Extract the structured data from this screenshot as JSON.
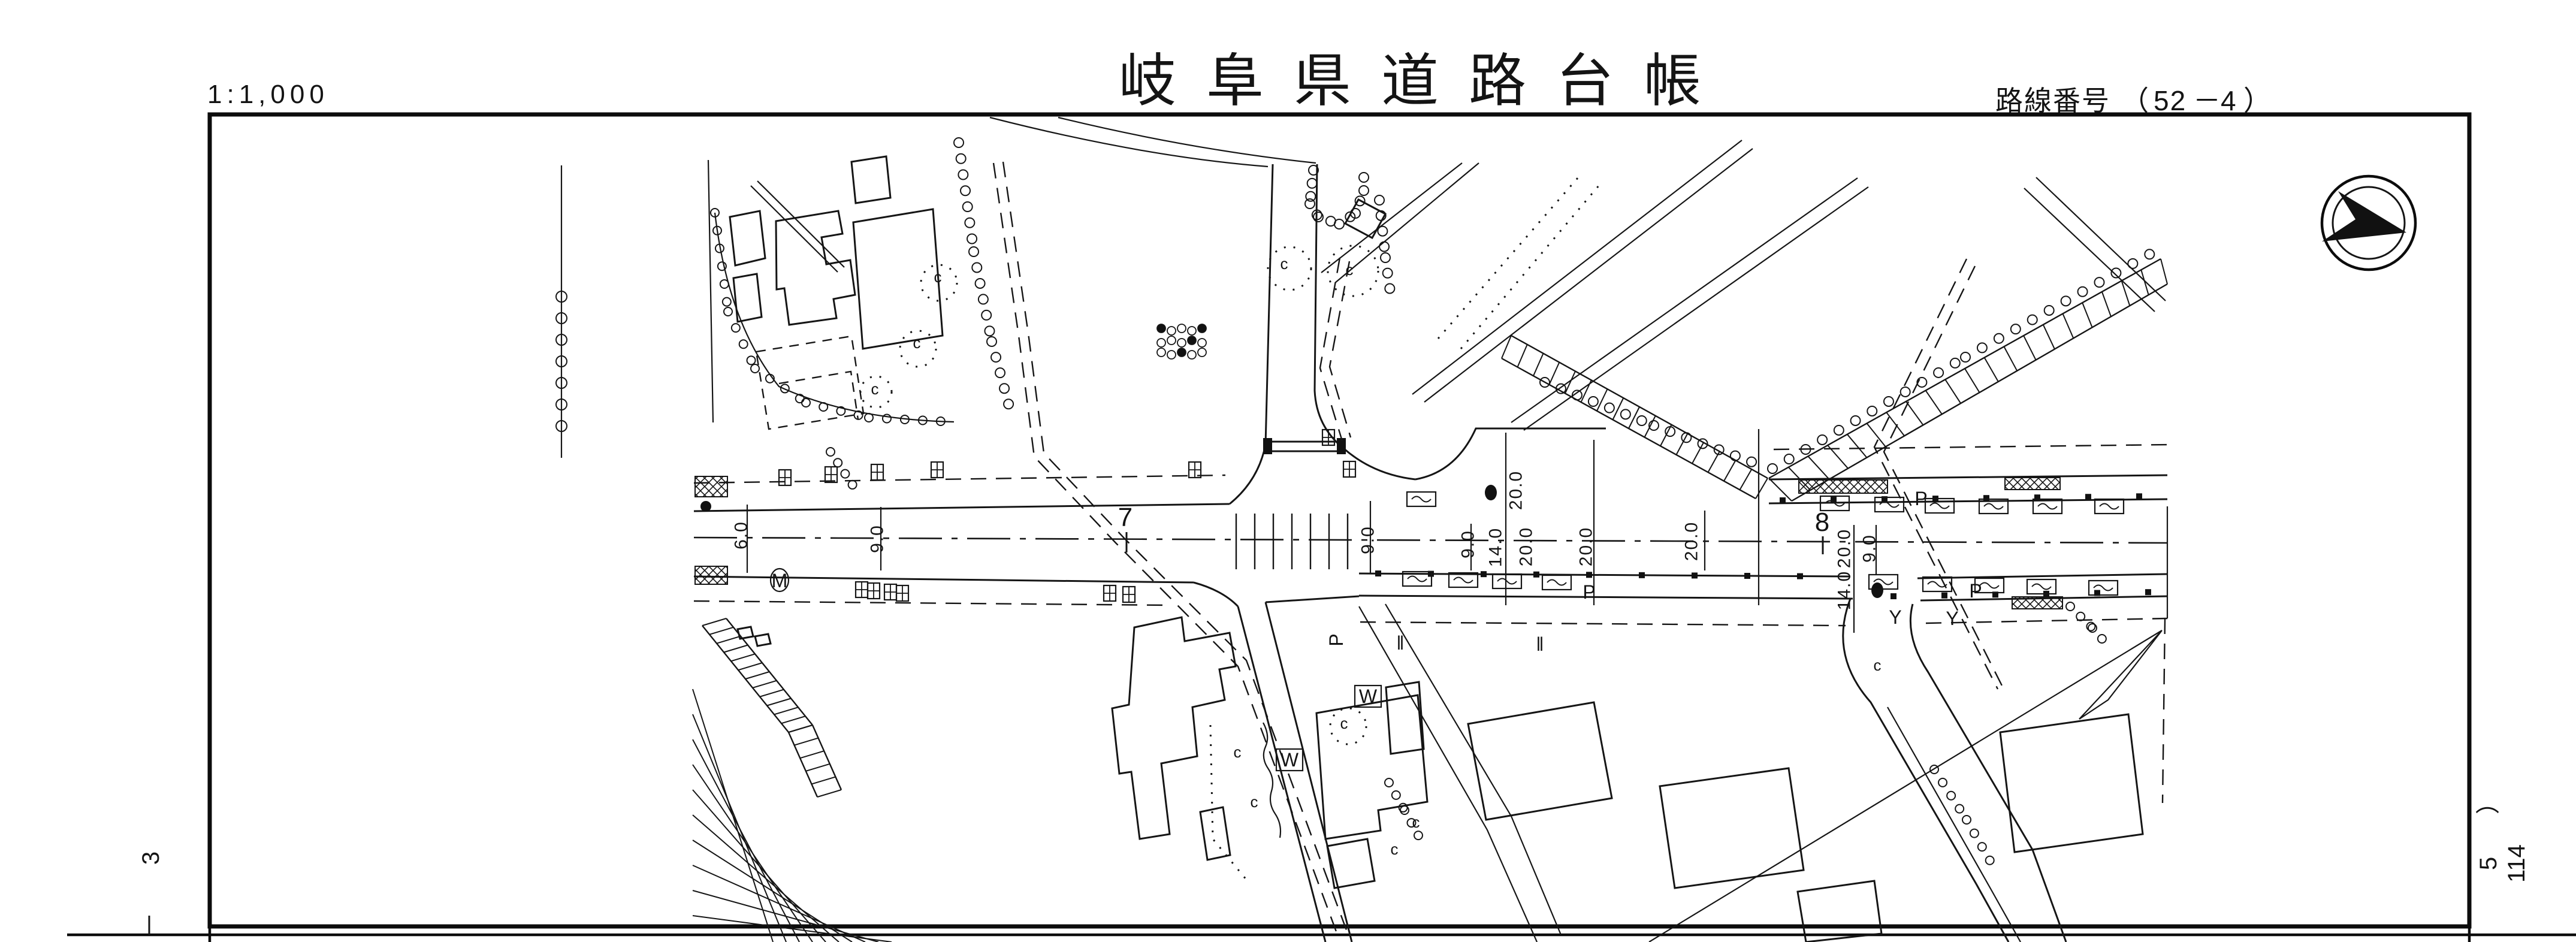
{
  "header": {
    "scale": "1:1,000",
    "title": "岐阜県道路台帳",
    "route_prefix": "路線番号",
    "route_open": "（",
    "route_main": "52",
    "route_dash": "－",
    "route_branch": "4",
    "route_close": "）"
  },
  "margins": {
    "left_sheet_no": "3",
    "right_paren": "）",
    "right_digit": "5",
    "right_number": "114"
  },
  "compass": {
    "icon": "north-arrow"
  },
  "map": {
    "stations": [
      {
        "label": "7"
      },
      {
        "label": "8"
      }
    ],
    "dims": [
      {
        "v": "6.0"
      },
      {
        "v": "9.0"
      },
      {
        "v": "9.0"
      },
      {
        "v": "9.0"
      },
      {
        "v": "14.0"
      },
      {
        "v": "20.0"
      },
      {
        "v": "20.0"
      },
      {
        "v": "20.0"
      },
      {
        "v": "20.0"
      },
      {
        "v": "20.0"
      },
      {
        "v": "14.0"
      },
      {
        "v": "9.0"
      }
    ],
    "letters": {
      "manhole": "M",
      "pole": "P",
      "valve": "Y",
      "well": "W",
      "tree": "c",
      "paddy": "‖"
    }
  }
}
